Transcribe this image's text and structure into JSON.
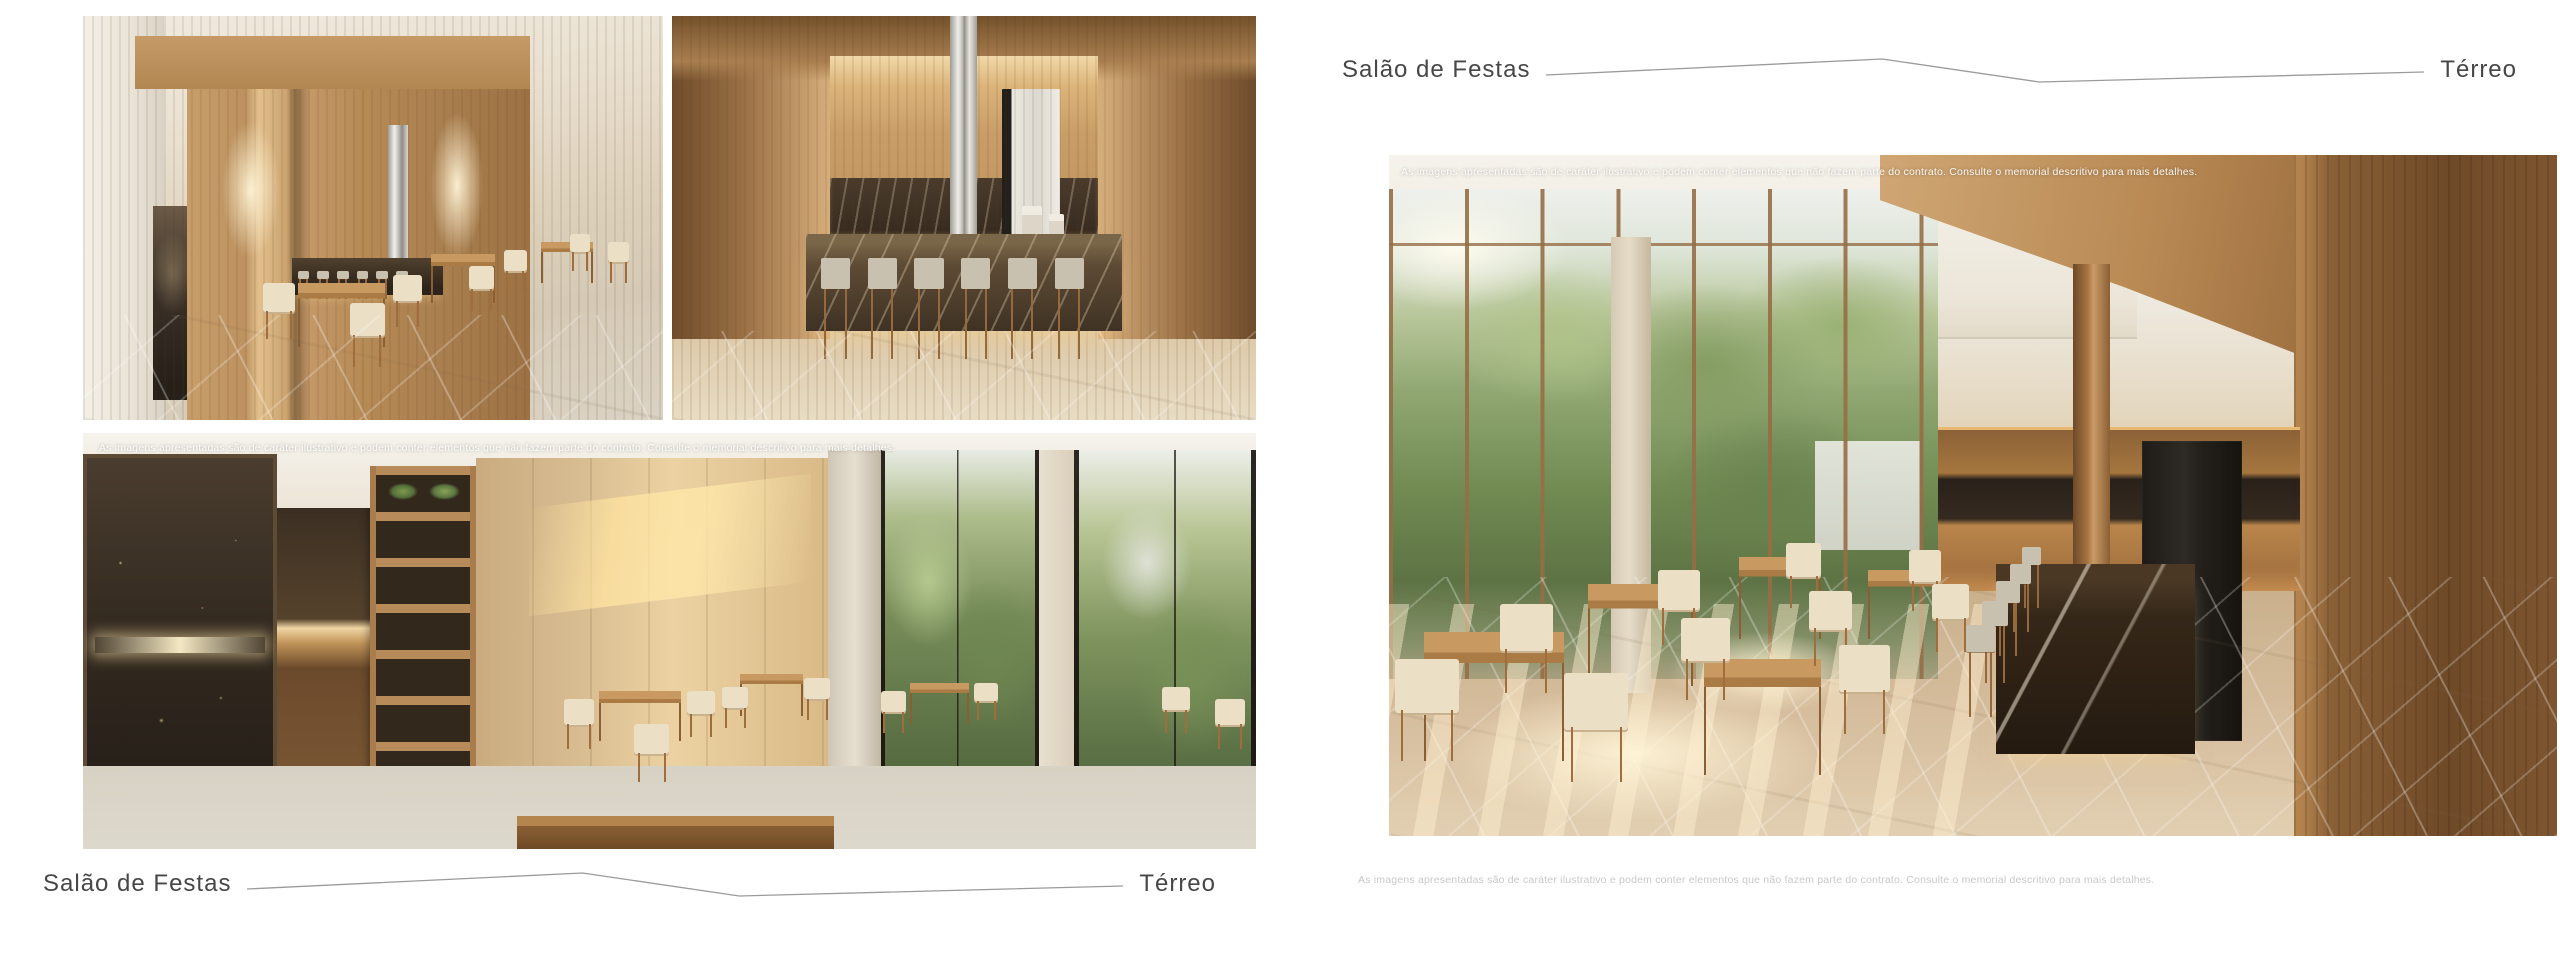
{
  "spread": {
    "disclaimer": "As imagens apresentadas são de caráter ilustrativo e podem conter elementos que não fazem parte do contrato. Consulte o memorial descritivo para mais detalhes."
  },
  "left_page": {
    "footer": {
      "title": "Salão de Festas",
      "floor": "Térreo"
    }
  },
  "right_page": {
    "header": {
      "title": "Salão de Festas",
      "floor": "Térreo"
    }
  },
  "colors": {
    "background": "#ffffff",
    "caption_text": "#474747",
    "caption_line": "#9b9b9b",
    "overlay_disclaimer_text": "#ffffff",
    "muted_disclaimer_text": "#c9c9c9",
    "wood_accent": "#a5773f",
    "marble_dark": "#2e2620"
  },
  "renders": {
    "top_left_label": "party-hall-lounge-render",
    "top_right_label": "party-hall-bar-render",
    "bottom_left_label": "party-hall-buffet-render",
    "right_label": "party-hall-panorama-render"
  }
}
